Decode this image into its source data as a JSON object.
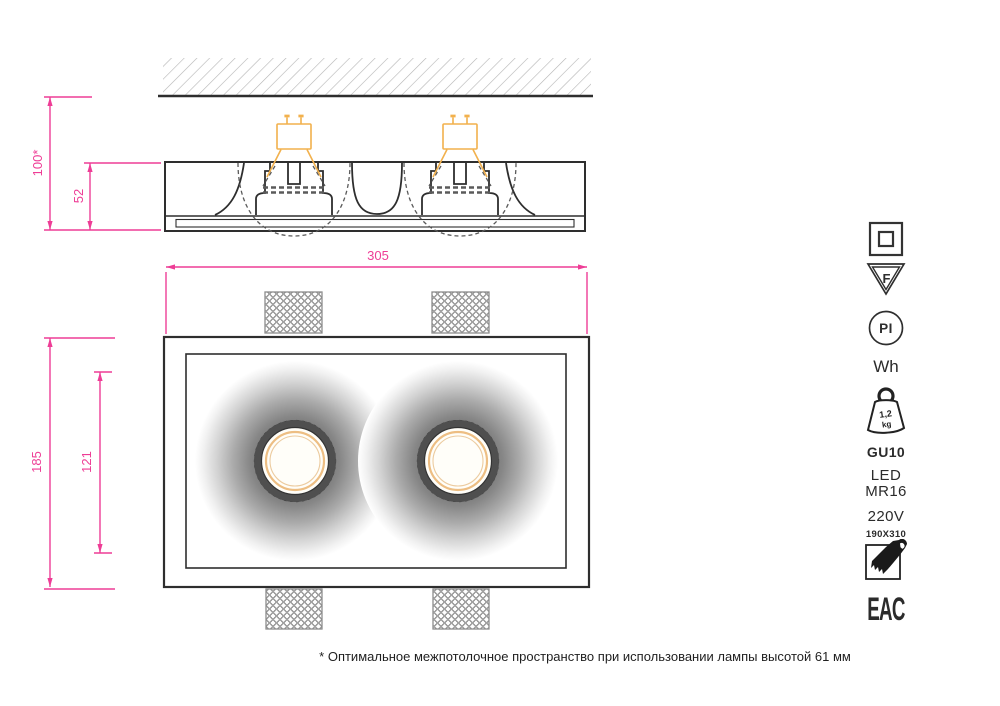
{
  "dimensions": {
    "ceiling_space": "100*",
    "fixture_depth": "52",
    "width": "305",
    "height": "185",
    "inner_height": "121"
  },
  "side_panel": {
    "f_mark": "F",
    "pi_mark": "PI",
    "color_label": "Wh",
    "weight_value": "1,2",
    "weight_unit": "kg",
    "socket": "GU10",
    "lamp_line1": "LED",
    "lamp_line2": "MR16",
    "voltage": "220V",
    "cutout_size": "190X310",
    "cert_mark": "EAC"
  },
  "footnote": "* Оптимальное межпотолочное пространство при использовании лампы высотой 61 мм",
  "colors": {
    "dimension": "#ee3d96",
    "lamp": "#f2b14d",
    "line": "#2e2e2e",
    "hatch": "#b4b4b4",
    "spot_ring_orange": "#edbe83"
  }
}
